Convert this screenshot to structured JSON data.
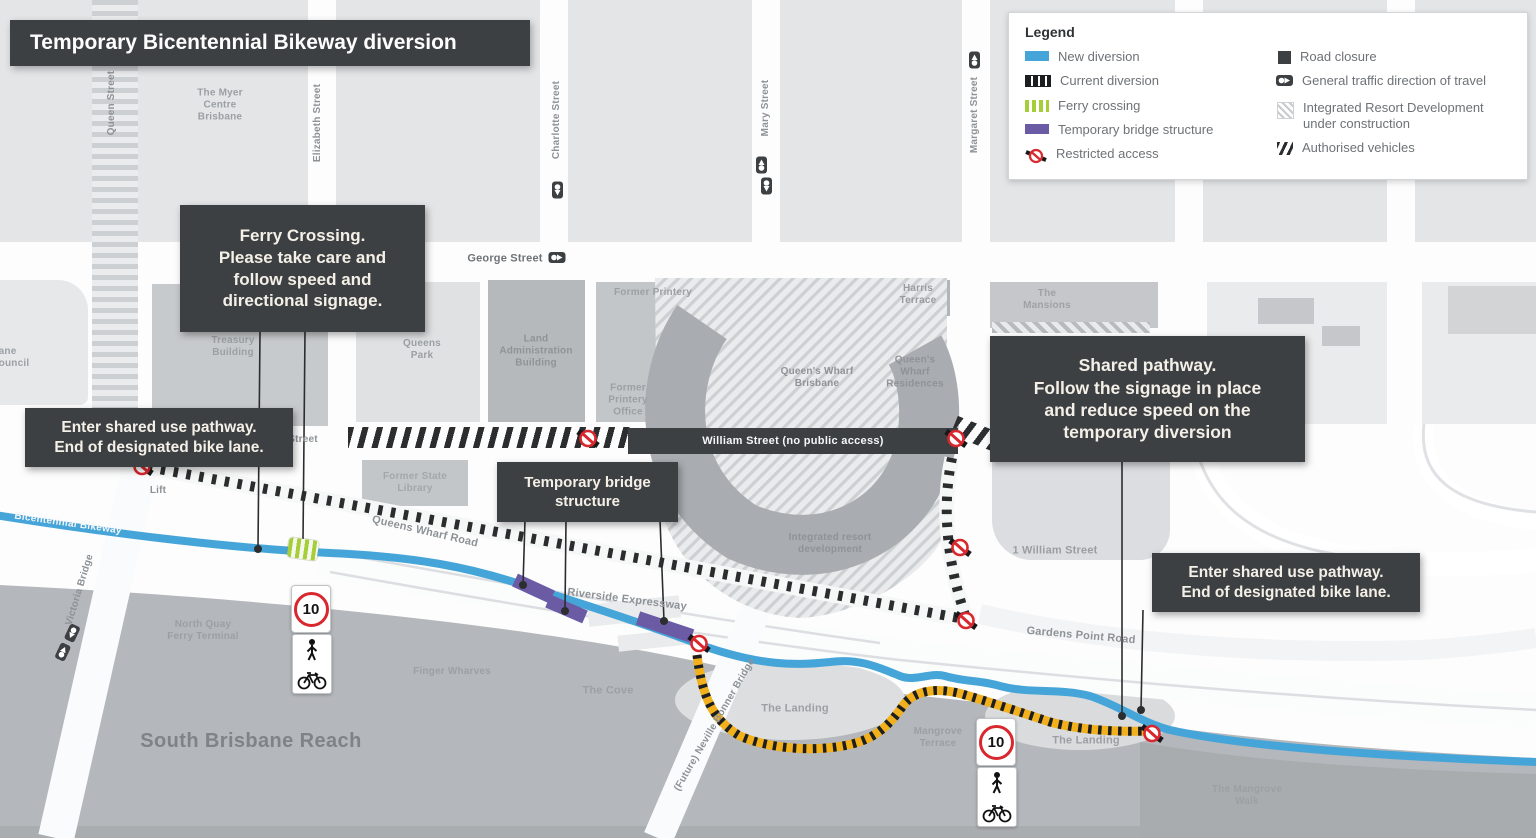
{
  "title": "Temporary Bicentennial Bikeway diversion",
  "legend": {
    "title": "Legend",
    "left": [
      {
        "id": "new-diversion",
        "label": "New diversion"
      },
      {
        "id": "current-diversion",
        "label": "Current diversion"
      },
      {
        "id": "ferry-crossing",
        "label": "Ferry crossing"
      },
      {
        "id": "temporary-bridge-structure",
        "label": "Temporary bridge structure"
      },
      {
        "id": "restricted-access",
        "label": "Restricted access"
      }
    ],
    "right": [
      {
        "id": "road-closure",
        "label": "Road closure"
      },
      {
        "id": "general-traffic-direction",
        "label": "General traffic direction of travel"
      },
      {
        "id": "integrated-resort-development",
        "label": "Integrated Resort Development\nunder construction"
      },
      {
        "id": "authorised-vehicles",
        "label": "Authorised vehicles"
      }
    ]
  },
  "callouts": {
    "ferry": "Ferry Crossing.\nPlease take care and\nfollow speed and\ndirectional signage.",
    "enter_left": "Enter shared use pathway.\nEnd of designated bike lane.",
    "temporary_bridge": "Temporary bridge\nstructure",
    "shared_pathway": "Shared pathway.\nFollow the signage in place\nand reduce speed on the\ntemporary diversion",
    "enter_right": "Enter shared use pathway.\nEnd of designated bike lane."
  },
  "streets": {
    "queen": "Queen Street",
    "elizabeth": "Elizabeth Street",
    "charlotte": "Charlotte Street",
    "mary": "Mary Street",
    "margaret": "Margaret Street",
    "george": "George Street",
    "william_closed": "William Street (no public access)",
    "william_partial": "Street",
    "queens_wharf_road": "Queens Wharf Road",
    "riverside_expressway": "Riverside Expressway",
    "gardens_point_road": "Gardens Point Road",
    "neville_bonner_bridge": "(Future) Neville Bonner Bridge",
    "victoria_bridge": "Victoria Bridge",
    "bikeway": "Bicentennial Bikeway"
  },
  "places": {
    "myer_centre": "The Myer\nCentre\nBrisbane",
    "council_partial": "ane\nouncil",
    "treasury": "Treasury\nBuilding",
    "queens_park": "Queens\nPark",
    "land_admin": "Land\nAdministration\nBuilding",
    "former_printery": "Former Printery",
    "former_printery_office": "Former\nPrintery\nOffice",
    "former_state_library": "Former State\nLibrary",
    "queens_wharf_brisbane": "Queen's Wharf\nBrisbane",
    "harris_terrace": "Harris\nTerrace",
    "qw_residences": "Queen's\nWharf\nResidences",
    "the_mansions": "The\nMansions",
    "integrated_resort": "Integrated resort\ndevelopment",
    "one_william_street": "1 William Street",
    "lift": "Lift",
    "north_quay": "North Quay\nFerry Terminal",
    "finger_wharves": "Finger Wharves",
    "the_cove": "The Cove",
    "the_landing_1": "The Landing",
    "the_landing_2": "The Landing",
    "mangrove_terrace": "Mangrove\nTerrace",
    "south_brisbane_reach": "South Brisbane Reach",
    "mangrove_walk": "The Mangrove\nWalk"
  },
  "signs": {
    "speed_limit": "10"
  },
  "colors": {
    "new_diversion": "#46a5d8",
    "current_diversion": "#2a2c2e",
    "ferry_crossing": "#a6ce39",
    "temporary_bridge": "#6b5ba5",
    "restricted_red": "#d9272e",
    "diversion_yellow": "#f2b01d",
    "callout_dark": "#3d4043"
  }
}
